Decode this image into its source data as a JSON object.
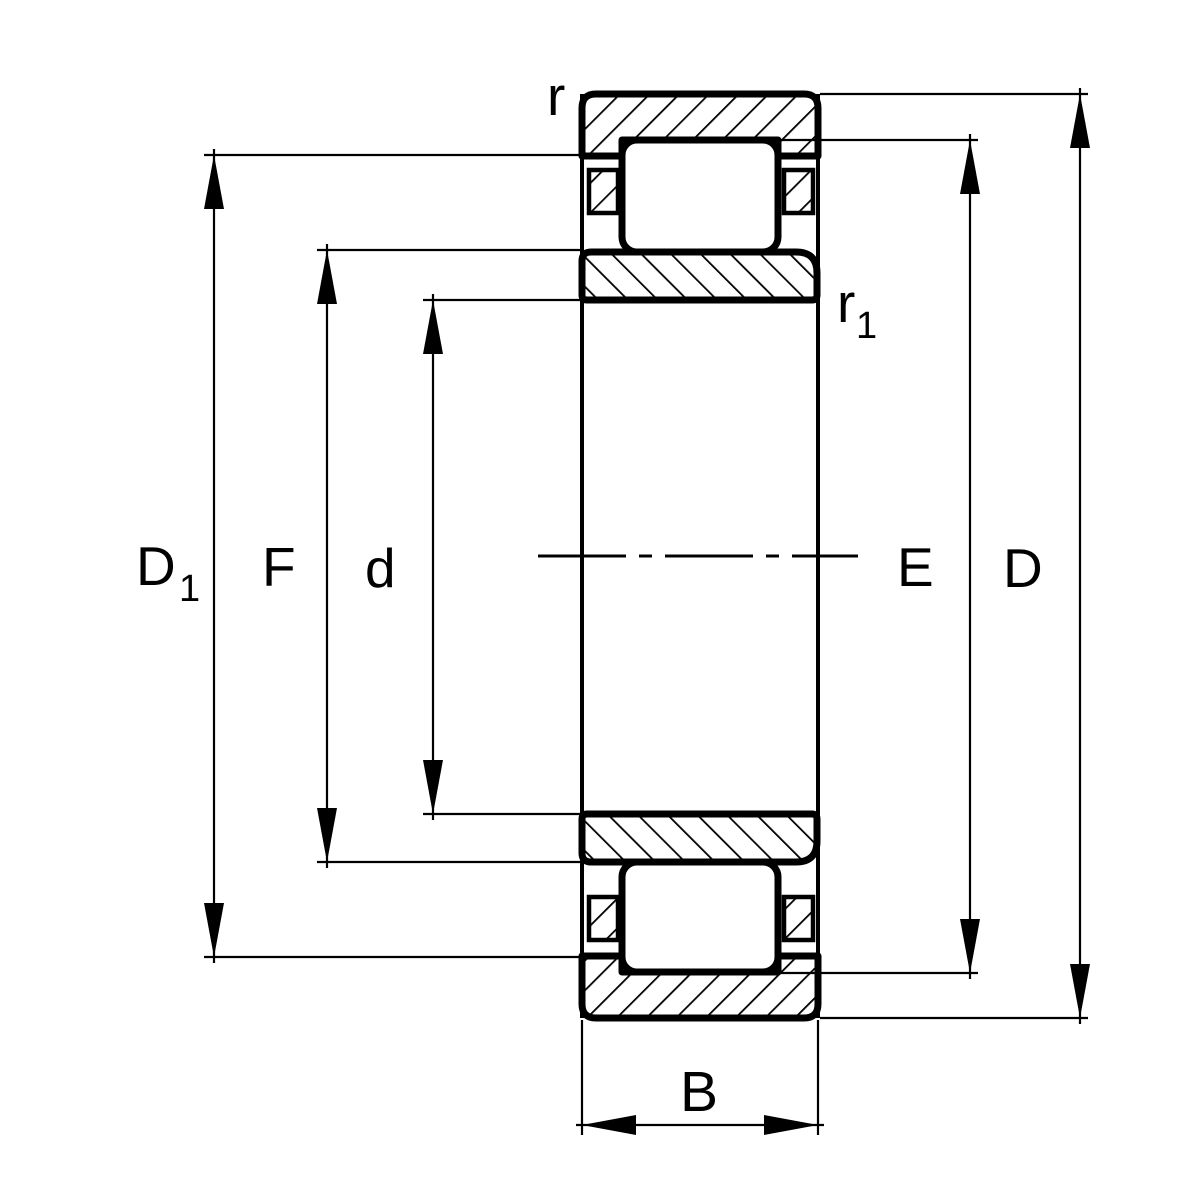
{
  "page": {
    "background": "#ffffff"
  },
  "drawing": {
    "kind": "cylindrical-roller-bearing-section-pictogram",
    "line_color": "#000000",
    "fill_color": "#ffffff",
    "labels": {
      "r": "r",
      "r1": {
        "base": "r",
        "sub": "1"
      },
      "D1": {
        "base": "D",
        "sub": "1"
      },
      "F": "F",
      "d": "d",
      "E": "E",
      "D": "D",
      "B": "B"
    }
  }
}
